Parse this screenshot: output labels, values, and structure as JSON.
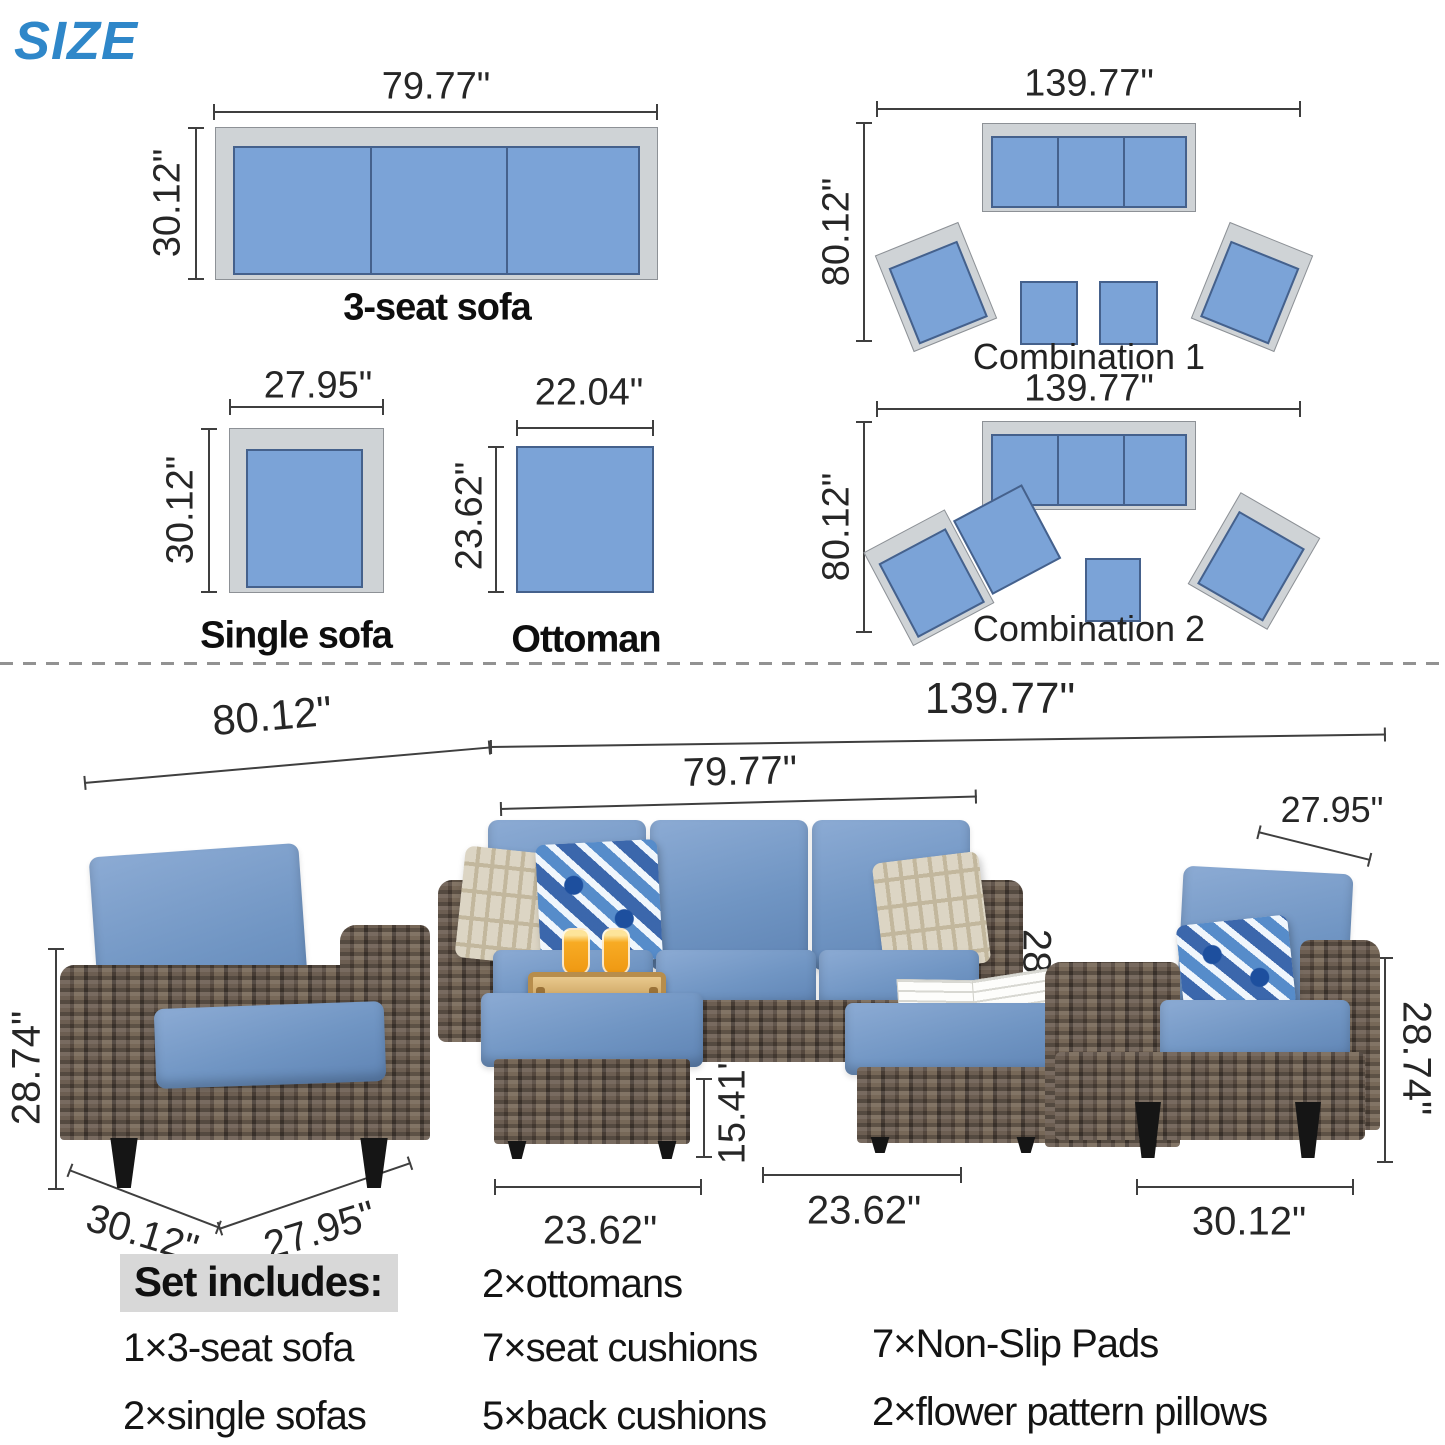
{
  "title": "SIZE",
  "labels": {
    "three_seat": "3-seat sofa",
    "single": "Single sofa",
    "ottoman": "Ottoman",
    "combo1": "Combination 1",
    "combo2": "Combination 2"
  },
  "dims": {
    "sofa_w": "79.77\"",
    "sofa_d": "30.12\"",
    "single_w": "27.95\"",
    "single_d": "30.12\"",
    "ottoman_w": "22.04\"",
    "ottoman_d": "23.62\"",
    "combo1_w": "139.77\"",
    "combo1_d": "80.12\"",
    "combo2_w": "139.77\"",
    "combo2_d": "80.12\""
  },
  "photo_dims": {
    "set_depth": "80.12\"",
    "set_width": "139.77\"",
    "sofa_width": "79.77\"",
    "right_chair_width": "27.95\"",
    "left_chair_height": "28.74\"",
    "sofa_height": "28.74\"",
    "right_chair_height": "28.74\"",
    "left_chair_depth": "30.12\"",
    "left_chair_width": "27.95\"",
    "ottoman_height": "15.41\"",
    "ottoman_left_width": "23.62\"",
    "ottoman_right_width": "23.62\"",
    "right_chair_depth": "30.12\""
  },
  "set_includes": {
    "heading": "Set includes:",
    "items": [
      "1×3-seat sofa",
      "2×single sofas",
      "2×ottomans",
      "7×seat cushions",
      "5×back cushions",
      "7×Non-Slip Pads",
      "2×flower pattern pillows"
    ]
  },
  "colors": {
    "accent_blue": "#2f87c9",
    "diagram_cushion_blue": "#7ba3d7",
    "diagram_frame_gray": "#cfd3d6",
    "photo_cushion_blue": "#7095c3",
    "wicker_brown": "#60544a"
  }
}
